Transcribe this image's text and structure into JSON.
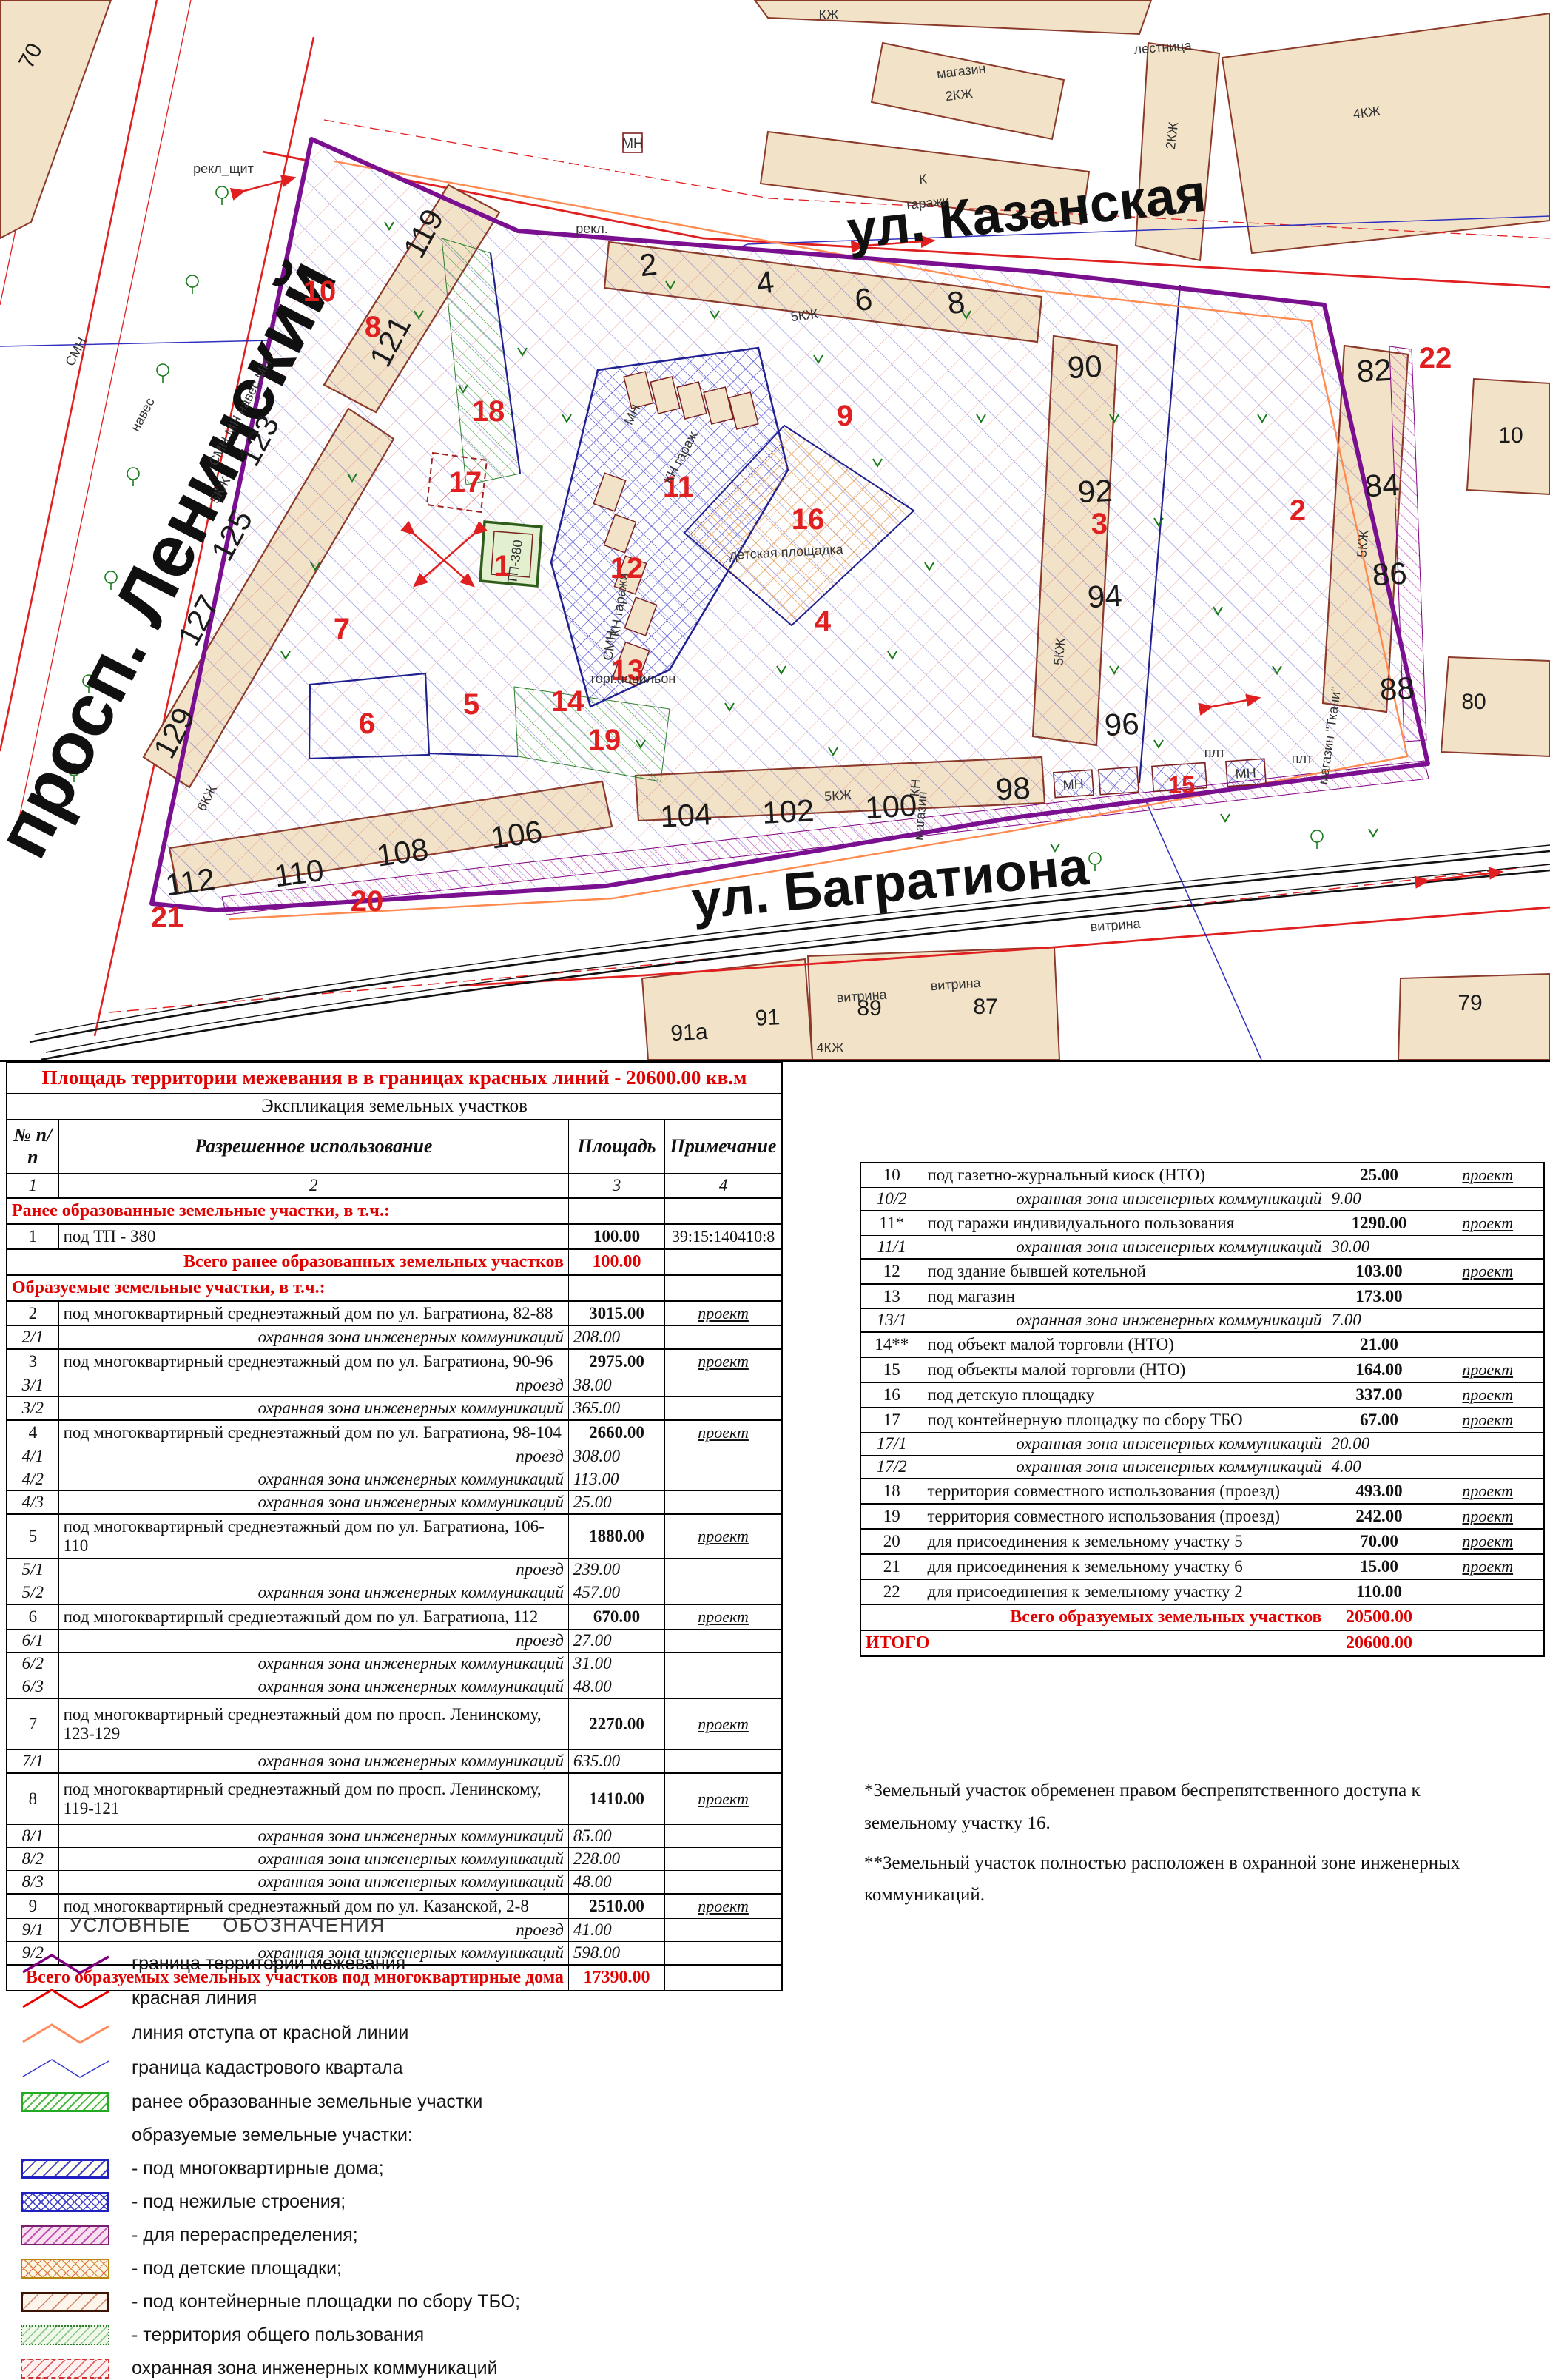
{
  "map": {
    "streets": {
      "leninsky": "просп. Ленинский",
      "kazanskaya": "ул. Казанская",
      "bagrationa": "ул. Багратиона"
    },
    "buildings": {
      "b119": "119",
      "b121": "121",
      "b123": "123",
      "b125": "125",
      "b127": "127",
      "b129": "129",
      "b2": "2",
      "b4": "4",
      "b6": "6",
      "b8": "8",
      "b90": "90",
      "b92": "92",
      "b94": "94",
      "b96": "96",
      "b82": "82",
      "b84": "84",
      "b86": "86",
      "b88": "88",
      "b98": "98",
      "b100": "100",
      "b102": "102",
      "b104": "104",
      "b106": "106",
      "b108": "108",
      "b110": "110",
      "b112": "112",
      "b70": "70",
      "b10": "10",
      "b80": "80",
      "b79": "79",
      "b89": "89",
      "b87": "87",
      "b91": "91",
      "b91a": "91а"
    },
    "parcels": {
      "p1": "1",
      "p2": "2",
      "p3": "3",
      "p4": "4",
      "p5": "5",
      "p6": "6",
      "p7": "7",
      "p8": "8",
      "p9": "9",
      "p10": "10",
      "p11": "11",
      "p12": "12",
      "p13": "13",
      "p14": "14",
      "p15": "15",
      "p16": "16",
      "p17": "17",
      "p18": "18",
      "p19": "19",
      "p20": "20",
      "p21": "21",
      "p22": "22"
    },
    "annotations": {
      "smn1": "СМН",
      "naves1": "навес",
      "magazin": "магазин",
      "m2kzh": "2КЖ",
      "kzh": "КЖ",
      "k": "К",
      "garazhi": "гаражи",
      "lestnitsa": "лестница",
      "kzh4": "4КЖ",
      "kzh2": "2КЖ",
      "rekl_shchit": "рекл_щит",
      "rekl": "рекл.",
      "kzh5a": "5КЖ",
      "kzh5b": "5КЖ",
      "kzh5c": "5КЖ",
      "kzh5d": "5КЖ",
      "kzh5e": "5КЖ",
      "kzh6": "6КЖ",
      "detskaya": "детская площадка",
      "tp": "ТП-380",
      "mn": "МН",
      "kn_garazh": "КН гараж",
      "kn_garazhi": "КН гаражи",
      "smn2": "СМН",
      "torg": "торг.павильон",
      "mn2": "МН",
      "mn3": "МН",
      "kn_mag": "КН",
      "magazin2": "магазин",
      "mag_tkani": "магазин \"Ткани\"",
      "plt1": "плт",
      "plt2": "плт",
      "vitrina1": "витрина",
      "vitrina2": "витрина",
      "vitrina3": "витрина",
      "kzh4b": "4КЖ",
      "mn4": "МН",
      "smn_mn_naves": "СМН МН навес МН"
    }
  },
  "left_table": {
    "title": "Площадь территории межевания в в границах красных линий - 20600.00 кв.м",
    "subtitle": "Экспликация земельных участков",
    "headers": [
      "№ п/п",
      "Разрешенное использование",
      "Площадь",
      "Примечание"
    ],
    "col_numbers": [
      "1",
      "2",
      "3",
      "4"
    ],
    "rows": [
      {
        "type": "section",
        "text": "Ранее образованные земельные участки, в т.ч.:"
      },
      {
        "type": "main",
        "num": "1",
        "text": "под ТП - 380",
        "area": "100.00",
        "note": "39:15:140410:8"
      },
      {
        "type": "total",
        "text": "Всего ранее образованных земельных участков",
        "area": "100.00"
      },
      {
        "type": "section",
        "text": "Образуемые земельные участки, в т.ч.:"
      },
      {
        "type": "main",
        "num": "2",
        "text": "под многоквартирный среднеэтажный дом по ул. Багратиона, 82-88",
        "area": "3015.00",
        "note": "проект"
      },
      {
        "type": "sub",
        "num": "2/1",
        "text": "охранная зона инженерных коммуникаций",
        "area": "208.00"
      },
      {
        "type": "main",
        "num": "3",
        "text": "под многоквартирный среднеэтажный дом по ул. Багратиона, 90-96",
        "area": "2975.00",
        "note": "проект"
      },
      {
        "type": "sub",
        "num": "3/1",
        "text": "проезд",
        "area": "38.00"
      },
      {
        "type": "sub",
        "num": "3/2",
        "text": "охранная зона инженерных коммуникаций",
        "area": "365.00"
      },
      {
        "type": "main",
        "num": "4",
        "text": "под многоквартирный среднеэтажный дом по ул. Багратиона, 98-104",
        "area": "2660.00",
        "note": "проект"
      },
      {
        "type": "sub",
        "num": "4/1",
        "text": "проезд",
        "area": "308.00"
      },
      {
        "type": "sub",
        "num": "4/2",
        "text": "охранная зона инженерных коммуникаций",
        "area": "113.00"
      },
      {
        "type": "sub",
        "num": "4/3",
        "text": "охранная зона инженерных коммуникаций",
        "area": "25.00"
      },
      {
        "type": "main",
        "num": "5",
        "text": "под многоквартирный среднеэтажный дом по ул. Багратиона, 106-110",
        "area": "1880.00",
        "note": "проект"
      },
      {
        "type": "sub",
        "num": "5/1",
        "text": "проезд",
        "area": "239.00"
      },
      {
        "type": "sub",
        "num": "5/2",
        "text": "охранная зона инженерных коммуникаций",
        "area": "457.00"
      },
      {
        "type": "main",
        "num": "6",
        "text": "под многоквартирный среднеэтажный дом по ул. Багратиона, 112",
        "area": "670.00",
        "note": "проект"
      },
      {
        "type": "sub",
        "num": "6/1",
        "text": "проезд",
        "area": "27.00"
      },
      {
        "type": "sub",
        "num": "6/2",
        "text": "охранная зона инженерных коммуникаций",
        "area": "31.00"
      },
      {
        "type": "sub",
        "num": "6/3",
        "text": "охранная зона инженерных коммуникаций",
        "area": "48.00"
      },
      {
        "type": "main2",
        "num": "7",
        "text": "под многоквартирный среднеэтажный дом по просп. Ленинскому, 123-129",
        "area": "2270.00",
        "note": "проект"
      },
      {
        "type": "sub",
        "num": "7/1",
        "text": "охранная зона инженерных коммуникаций",
        "area": "635.00"
      },
      {
        "type": "main2",
        "num": "8",
        "text": "под многоквартирный среднеэтажный дом по просп. Ленинскому, 119-121",
        "area": "1410.00",
        "note": "проект"
      },
      {
        "type": "sub",
        "num": "8/1",
        "text": "охранная зона инженерных коммуникаций",
        "area": "85.00"
      },
      {
        "type": "sub",
        "num": "8/2",
        "text": "охранная зона инженерных коммуникаций",
        "area": "228.00"
      },
      {
        "type": "sub",
        "num": "8/3",
        "text": "охранная зона инженерных коммуникаций",
        "area": "48.00"
      },
      {
        "type": "main",
        "num": "9",
        "text": "под многоквартирный среднеэтажный дом по ул. Казанской, 2-8",
        "area": "2510.00",
        "note": "проект"
      },
      {
        "type": "sub",
        "num": "9/1",
        "text": "проезд",
        "area": "41.00"
      },
      {
        "type": "sub",
        "num": "9/2",
        "text": "охранная зона инженерных коммуникаций",
        "area": "598.00"
      },
      {
        "type": "total",
        "text": "Всего образуемых земельных участков под многоквартирные дома",
        "area": "17390.00"
      }
    ]
  },
  "right_table": {
    "rows": [
      {
        "type": "main",
        "num": "10",
        "text": "под газетно-журнальный киоск (НТО)",
        "area": "25.00",
        "note": "проект"
      },
      {
        "type": "sub",
        "num": "10/2",
        "text": "охранная зона инженерных коммуникаций",
        "area": "9.00"
      },
      {
        "type": "main",
        "num": "11*",
        "text": "под гаражи индивидуального пользования",
        "area": "1290.00",
        "note": "проект"
      },
      {
        "type": "sub",
        "num": "11/1",
        "text": "охранная зона инженерных коммуникаций",
        "area": "30.00"
      },
      {
        "type": "main",
        "num": "12",
        "text": "под здание бывшей котельной",
        "area": "103.00",
        "note": "проект"
      },
      {
        "type": "main",
        "num": "13",
        "text": "под магазин",
        "area": "173.00"
      },
      {
        "type": "sub",
        "num": "13/1",
        "text": "охранная зона инженерных коммуникаций",
        "area": "7.00"
      },
      {
        "type": "main",
        "num": "14**",
        "text": "под объект малой торговли (НТО)",
        "area": "21.00"
      },
      {
        "type": "main",
        "num": "15",
        "text": "под объекты малой торговли (НТО)",
        "area": "164.00",
        "note": "проект"
      },
      {
        "type": "main",
        "num": "16",
        "text": "под детскую площадку",
        "area": "337.00",
        "note": "проект"
      },
      {
        "type": "main",
        "num": "17",
        "text": "под контейнерную площадку по сбору ТБО",
        "area": "67.00",
        "note": "проект"
      },
      {
        "type": "sub",
        "num": "17/1",
        "text": "охранная зона инженерных коммуникаций",
        "area": "20.00"
      },
      {
        "type": "sub",
        "num": "17/2",
        "text": "охранная зона инженерных коммуникаций",
        "area": "4.00"
      },
      {
        "type": "main",
        "num": "18",
        "text": "территория совместного использования (проезд)",
        "area": "493.00",
        "note": "проект"
      },
      {
        "type": "main",
        "num": "19",
        "text": "территория совместного использования (проезд)",
        "area": "242.00",
        "note": "проект"
      },
      {
        "type": "main",
        "num": "20",
        "text": "для присоединения к земельному участку 5",
        "area": "70.00",
        "note": "проект"
      },
      {
        "type": "main",
        "num": "21",
        "text": "для присоединения к земельному участку 6",
        "area": "15.00",
        "note": "проект"
      },
      {
        "type": "main",
        "num": "22",
        "text": "для присоединения к земельному участку 2",
        "area": "110.00"
      },
      {
        "type": "total",
        "text": "Всего образуемых земельных участков",
        "area": "20500.00"
      },
      {
        "type": "itogo",
        "text": "ИТОГО",
        "area": "20600.00"
      }
    ]
  },
  "notes": [
    "*Земельный участок обременен правом беспрепятственного доступа к земельному участку 16.",
    "**Земельный участок полностью расположен в охранной зоне инженерных коммуникаций."
  ],
  "legend": {
    "title": "УСЛОВНЫЕ ОБОЗНАЧЕНИЯ",
    "items": [
      {
        "swatch": "zigzag",
        "color": "#800080",
        "label": "граница территории межевания"
      },
      {
        "swatch": "zigzag",
        "color": "#ee0000",
        "label": "красная линия"
      },
      {
        "swatch": "zigzag",
        "color": "#ff8a60",
        "label": "линия отступа от красной линии"
      },
      {
        "swatch": "zigzag-thin",
        "color": "#3333cc",
        "label": "граница кадастрового квартала"
      },
      {
        "swatch": "rect-green-hatch",
        "label": "ранее образованные земельные участки"
      },
      {
        "swatch": "none",
        "label": "образуемые земельные участки:"
      },
      {
        "swatch": "rect-blue-diag",
        "label": "- под многоквартирные дома;"
      },
      {
        "swatch": "rect-blue-cross",
        "label": "- под нежилые строения;"
      },
      {
        "swatch": "rect-pink-diag",
        "label": "- для перераспределения;"
      },
      {
        "swatch": "rect-orange-cross",
        "label": "- под детские площадки;"
      },
      {
        "swatch": "rect-tbo",
        "label": "- под контейнерные площадки по сбору ТБО;"
      },
      {
        "swatch": "rect-commons",
        "label": "- территория общего пользования"
      },
      {
        "swatch": "rect-red-hatch",
        "label": "охранная зона инженерных коммуникаций"
      },
      {
        "swatch": "rect-plain",
        "label": "внутриквартальные проезды"
      }
    ]
  },
  "colors": {
    "table_red": "#e00000",
    "boundary_purple": "#7a1090",
    "red_line": "#e02020",
    "setback_orange": "#ff8a50",
    "cadastre_blue": "#3030c0",
    "parcel_blue": "#3a3ad0",
    "hatch_red": "#e06060",
    "green": "#2f9e2f",
    "pink": "#c050c0",
    "tan": "#f2e3c8"
  }
}
